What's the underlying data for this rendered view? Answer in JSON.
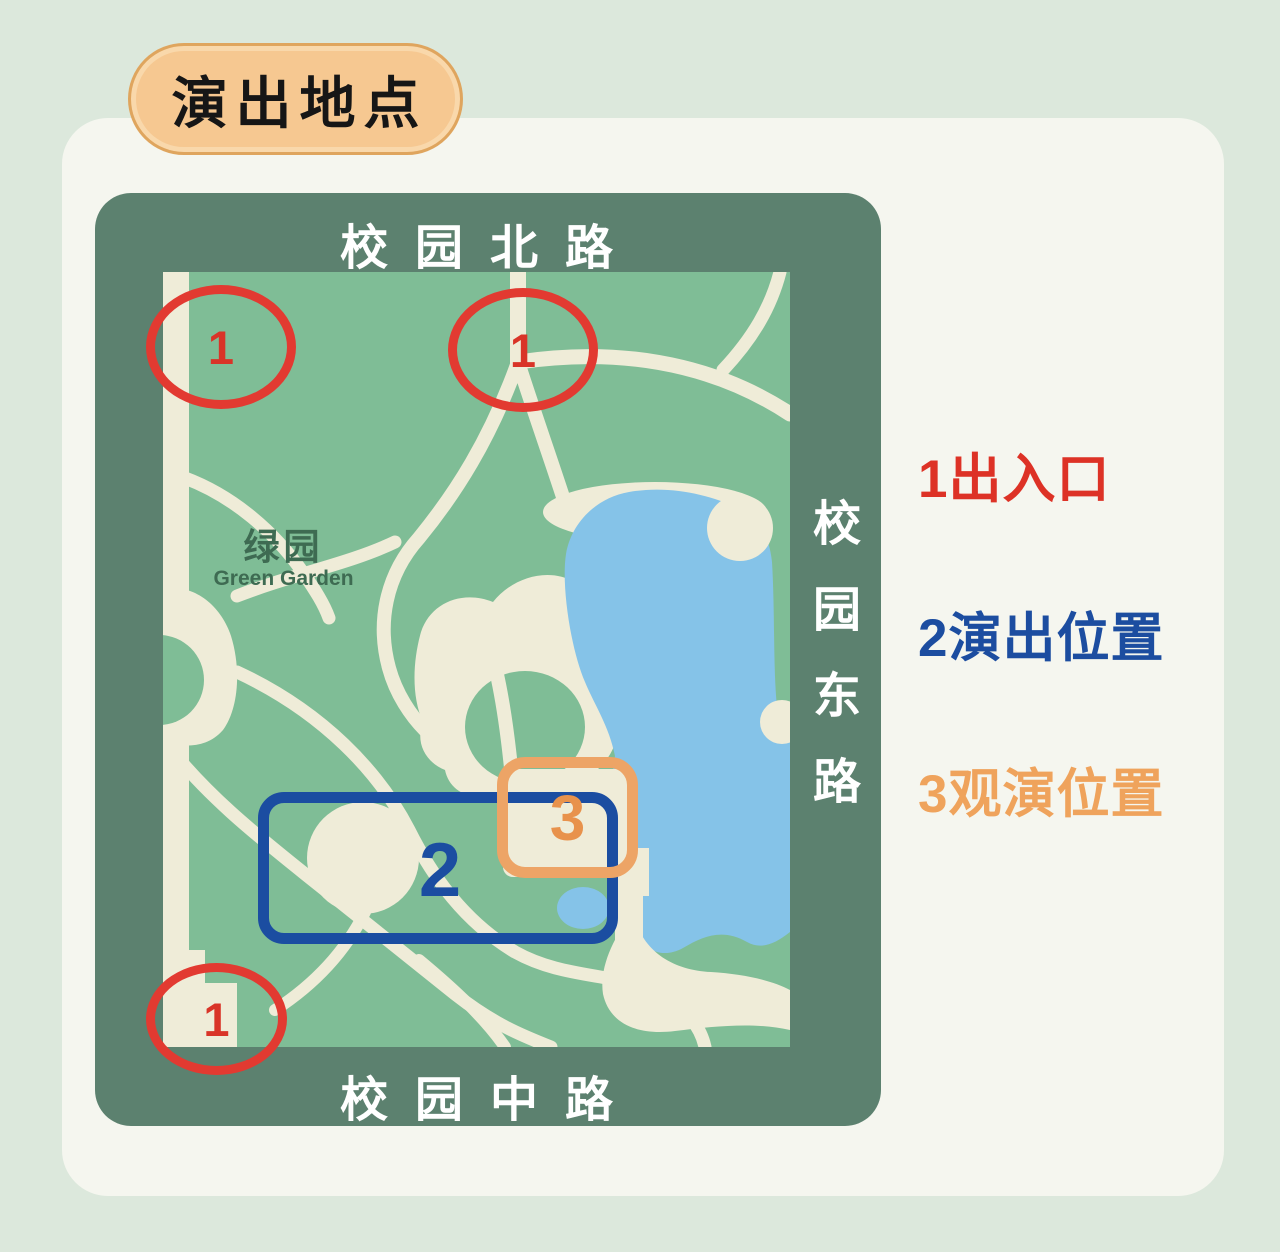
{
  "title": "演出地点",
  "roads": {
    "north": "校园北路",
    "middle": "校园中路",
    "east": "校园东路"
  },
  "garden": {
    "name_zh": "绿园",
    "name_en": "Green Garden"
  },
  "markers": {
    "entrance_top_left": "1",
    "entrance_top_center": "1",
    "entrance_bottom_left": "1",
    "stage": "2",
    "viewing": "3"
  },
  "legend": [
    {
      "num": "1",
      "label": "出入口",
      "color": "#dd3226"
    },
    {
      "num": "2",
      "label": "演出位置",
      "color": "#1c4da0"
    },
    {
      "num": "3",
      "label": "观演位置",
      "color": "#efa35c"
    }
  ],
  "colors": {
    "page_bg": "#dce8dc",
    "card_bg": "#f5f6ef",
    "badge_bg": "#f6c891",
    "badge_border": "#dfa55e",
    "frame_green": "#5c816f",
    "map_green": "#7fbd96",
    "path_cream": "#efecd8",
    "lake_blue": "#85c3e8",
    "entrance_red": "#e23a31",
    "stage_blue": "#1b4da1",
    "viewing_orange": "#eda466",
    "garden_text": "#3e6b52"
  }
}
